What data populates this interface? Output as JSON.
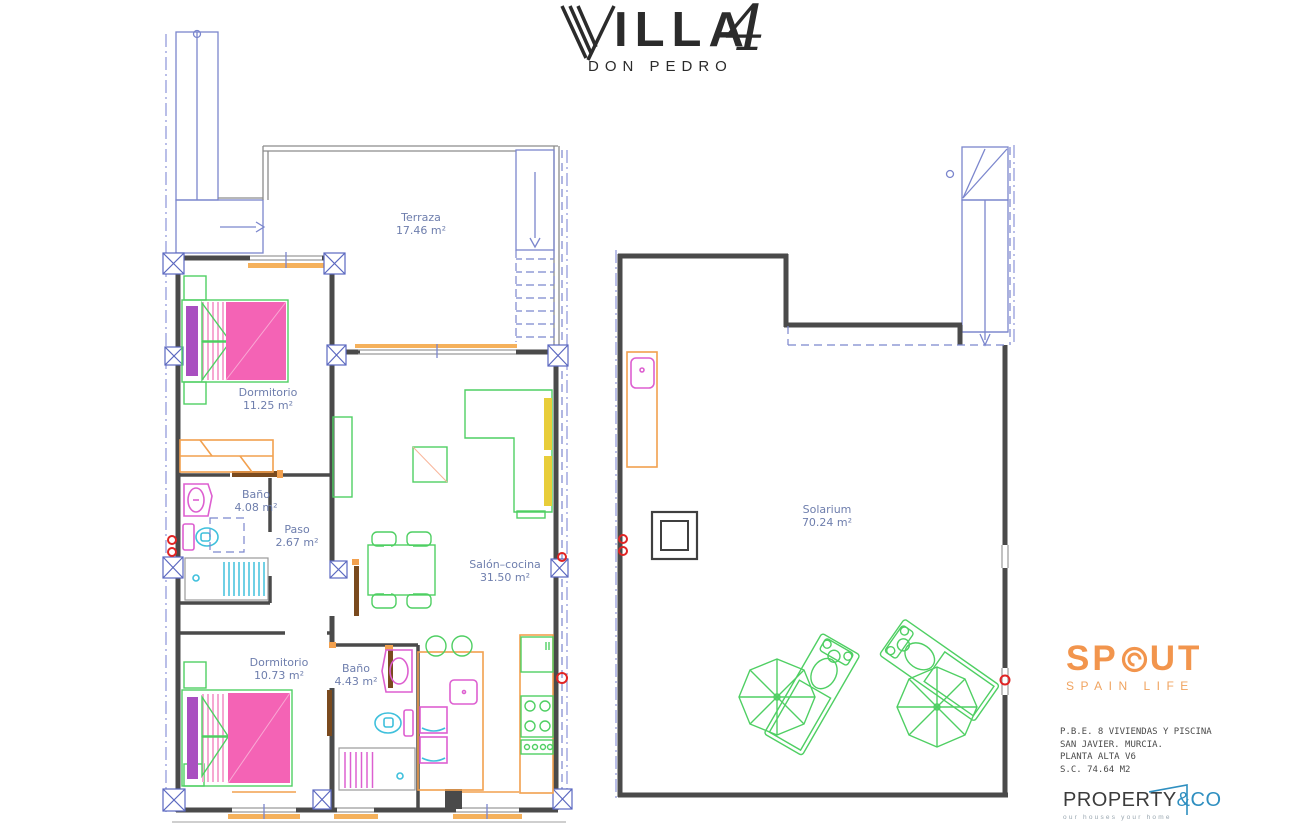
{
  "title": {
    "villa_v": "V",
    "villa_rest": "ILLA",
    "number": "4",
    "subtitle": "DON PEDRO"
  },
  "plans": {
    "left": {
      "terraza": {
        "name": "Terraza",
        "area": "17.46 m²"
      },
      "dormitorio1": {
        "name": "Dormitorio",
        "area": "11.25 m²"
      },
      "bano1": {
        "name": "Baño",
        "area": "4.08 m²"
      },
      "paso": {
        "name": "Paso",
        "area": "2.67 m²"
      },
      "salon": {
        "name": "Salón–cocina",
        "area": "31.50 m²"
      },
      "dormitorio2": {
        "name": "Dormitorio",
        "area": "10.73 m²"
      },
      "bano2": {
        "name": "Baño",
        "area": "4.43 m²"
      }
    },
    "right": {
      "solarium": {
        "name": "Solarium",
        "area": "70.24 m²"
      }
    }
  },
  "branding": {
    "spout": {
      "pre": "SP",
      "post": "UT",
      "tagline": "SPAIN LIFE"
    },
    "project": {
      "line1": "P.B.E. 8 VIVIENDAS Y PISCINA",
      "line2": "SAN JAVIER. MURCIA.",
      "line3": "PLANTA ALTA V6",
      "line4": "S.C. 74.64 M2"
    },
    "property": {
      "main": "PROPERTY",
      "suffix": "&CO",
      "tagline": "our houses your home"
    }
  },
  "colors": {
    "label_blue": "#6e7ead",
    "wall": "#4a4a4a",
    "plan_blue": "#7b86cd",
    "furniture_green": "#4fcf63",
    "bed_pink": "#f463b5",
    "pillow_purple": "#a94fc0",
    "window_orange": "#f2a04e",
    "fixture_magenta": "#dd5fd0",
    "fixture_cyan": "#3fc0dc",
    "symbol_red": "#e02424",
    "sofa_salmon": "#f4906c",
    "table_yellow": "#f7d87e",
    "spout_orange": "#f2954d",
    "property_dark": "#3c3c3c",
    "property_blue": "#2f8fc0"
  }
}
